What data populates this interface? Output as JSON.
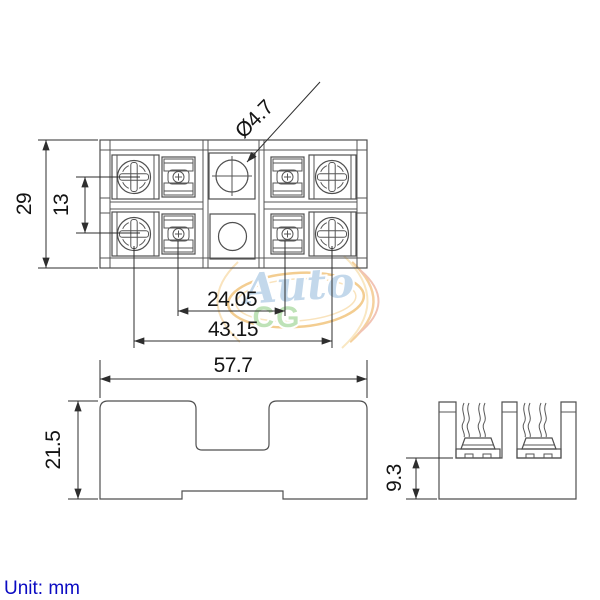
{
  "views": {
    "top": {
      "overall_height_mm": "29",
      "terminal_pitch_mm": "13",
      "hole_diameter": "Ø4.7",
      "inner_span_mm": "24.05",
      "screw_span_mm": "43.15"
    },
    "front": {
      "overall_width_mm": "57.7",
      "overall_height_mm": "21.5"
    },
    "side": {
      "base_height_mm": "9.3"
    }
  },
  "footer": {
    "unit_label": "Unit: mm"
  },
  "watermark": {
    "text_primary": "Auto",
    "text_secondary": "CG"
  }
}
